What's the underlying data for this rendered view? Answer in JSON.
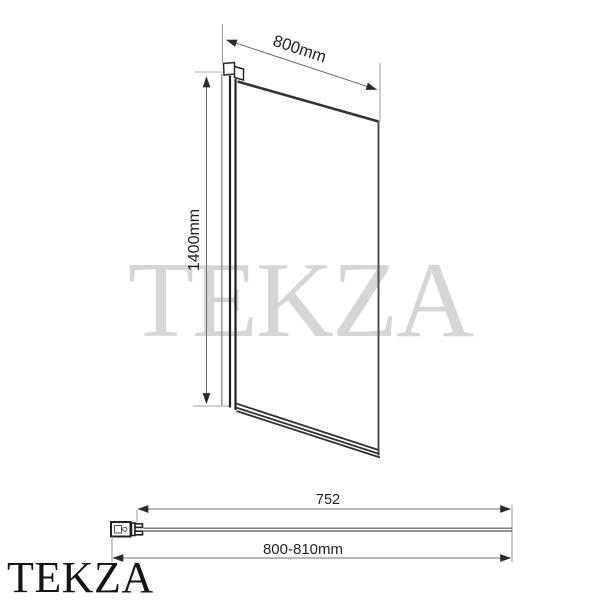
{
  "watermark": {
    "text": "TEKZA",
    "color": "#d6d6d6"
  },
  "brand_logo": {
    "text": "TEKZA",
    "color": "#141414"
  },
  "front_view": {
    "width_dimension": "800mm",
    "height_dimension": "1400mm"
  },
  "top_view": {
    "glass_width_dimension": "752",
    "overall_width_dimension": "800-810mm"
  },
  "colors": {
    "line_dark": "#2f2f2f",
    "line_medium": "#4f4f4f",
    "line_light": "#9a9a9a",
    "dimension_text": "#222222",
    "watermark_gray": "#d6d6d6"
  }
}
